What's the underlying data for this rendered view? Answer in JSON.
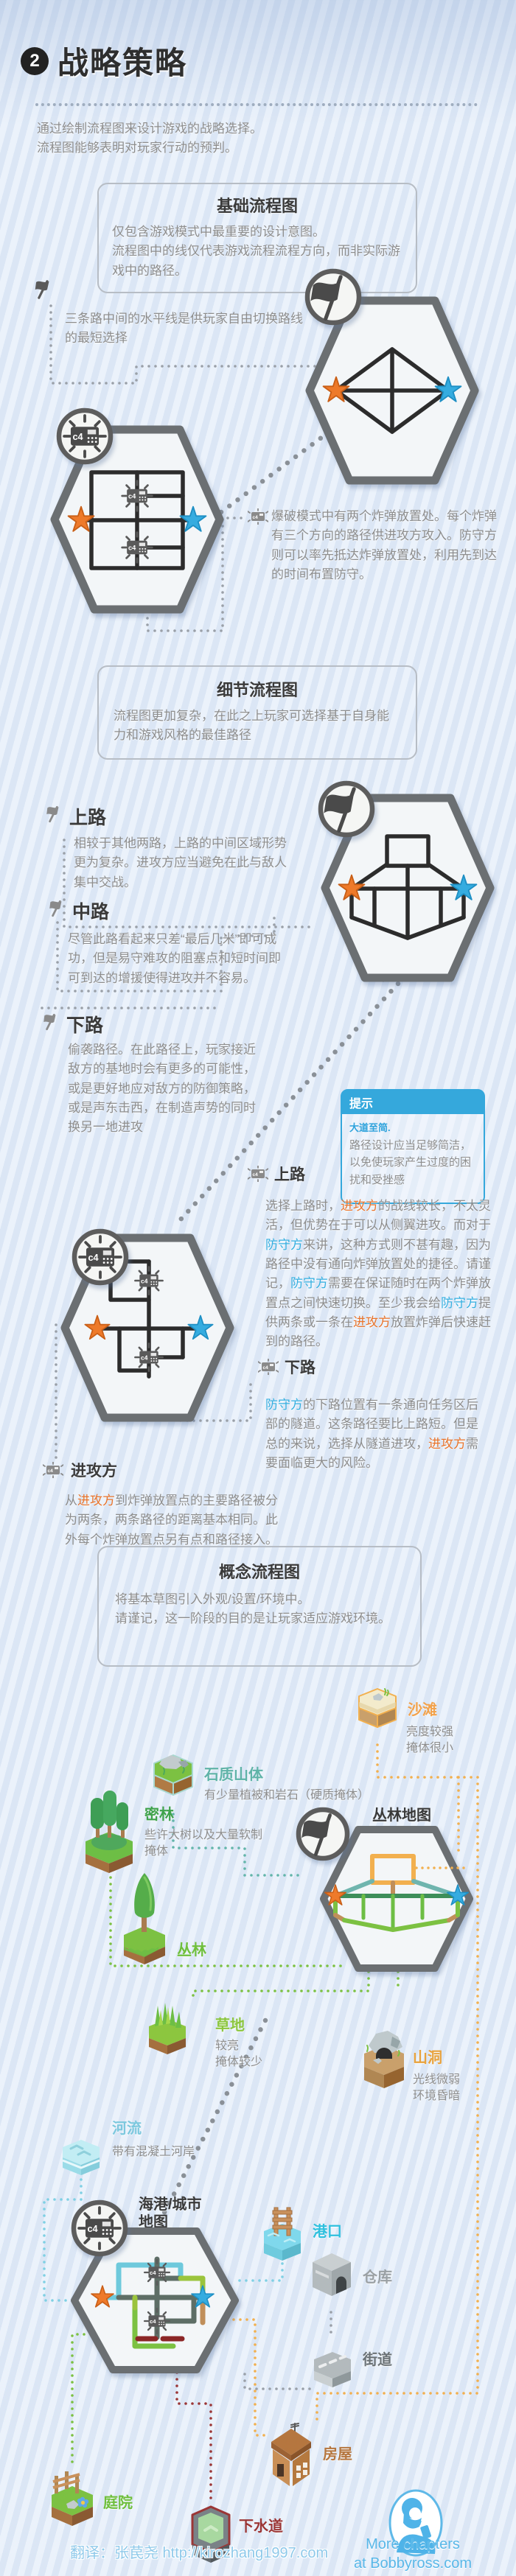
{
  "header": {
    "badge": "2",
    "title": "战略策略"
  },
  "intro": {
    "line1": "通过绘制流程图来设计游戏的战略选择。",
    "line2": "流程图能够表明对玩家行动的预判。"
  },
  "basic_box": {
    "title": "基础流程图",
    "line1": "仅包含游戏模式中最重要的设计意图。",
    "line2": "流程图中的线仅代表游戏流程流程方向，而非实际游戏中的路径。"
  },
  "ctf_note": {
    "text": "三条路中间的水平线是供玩家自由切换路线的最短选择"
  },
  "bomb_note": {
    "text": "爆破模式中有两个炸弹放置处。每个炸弹有三个方向的路径供进攻方攻入。防守方则可以率先抵达炸弹放置处，利用先到达的时间布置防守。"
  },
  "detail_box": {
    "title": "细节流程图",
    "body": "流程图更加复杂，在此之上玩家可选择基于自身能力和游戏风格的最佳路径"
  },
  "ctf_lanes": {
    "top": {
      "label": "上路",
      "body": "相较于其他两路，上路的中间区域形势更为复杂。进攻方应当避免在此与敌人集中交战。"
    },
    "mid": {
      "label": "中路",
      "body": "尽管此路看起来只差“最后几米”即可成功，但是易守难攻的阻塞点和短时间即可到达的增援使得进攻并不容易。"
    },
    "bottom": {
      "label": "下路",
      "body": "偷袭路径。在此路径上，玩家接近敌方的基地时会有更多的可能性，或是更好地应对敌方的防御策略，或是声东击西，在制造声势的同时换另一地进攻"
    }
  },
  "tip": {
    "title": "提示",
    "subtitle": "大道至简.",
    "body": "路径设计应当足够简洁，以免使玩家产生过度的困扰和受挫感"
  },
  "bomb_lanes": {
    "top": {
      "label": "上路",
      "segments": [
        {
          "t": "选择上路时，"
        },
        {
          "t": "进攻方",
          "c": "atk"
        },
        {
          "t": "的战线较长，不太灵活，但优势在于可以从侧翼进攻。而对于"
        },
        {
          "t": "防守方",
          "c": "def"
        },
        {
          "t": "来讲，这种方式则不甚有趣，因为路径中没有通向炸弹放置处的捷径。请谨记，"
        },
        {
          "t": "防守方",
          "c": "def"
        },
        {
          "t": "需要在保证随时在两个炸弹放置点之间快速切换。至少我会给"
        },
        {
          "t": "防守方",
          "c": "def"
        },
        {
          "t": "提供两条或一条在"
        },
        {
          "t": "进攻方",
          "c": "atk"
        },
        {
          "t": "放置炸弹后快速赶到的路径。"
        }
      ]
    },
    "bottom": {
      "label": "下路",
      "segments": [
        {
          "t": "防守方",
          "c": "def"
        },
        {
          "t": "的下路位置有一条通向任务区后部的隧道。这条路径要比上路短。但是总的来说，选择从隧道进攻，"
        },
        {
          "t": "进攻方",
          "c": "atk"
        },
        {
          "t": "需要面临更大的风险。"
        }
      ]
    },
    "attacker": {
      "label": "进攻方",
      "segments": [
        {
          "t": "从"
        },
        {
          "t": "进攻方",
          "c": "atk"
        },
        {
          "t": "到炸弹放置点的主要路径被分为两条，两条路径的距离基本相同。此外每个炸弹放置点另有点和路径接入。"
        }
      ]
    }
  },
  "concept_box": {
    "title": "概念流程图",
    "line1": "将基本草图引入外观/设置/环境中。",
    "line2": "请谨记，这一阶段的目的是让玩家适应游戏环境。"
  },
  "maps": {
    "jungle": "丛林地图",
    "harbor_line1": "海港/城市",
    "harbor_line2": "地图"
  },
  "terrain": {
    "beach": {
      "label": "沙滩",
      "desc1": "亮度较强",
      "desc2": "掩体很小"
    },
    "rocky": {
      "label": "石质山体",
      "desc1": "有少量植被和岩石（硬质掩体）"
    },
    "dense": {
      "label": "密林",
      "desc1": "些许大树以及大量软制掩体"
    },
    "jungle": {
      "label": "丛林"
    },
    "grass": {
      "label": "草地",
      "desc1": "较亮",
      "desc2": "掩体较少"
    },
    "cave": {
      "label": "山洞",
      "desc1": "光线微弱",
      "desc2": "环境昏暗"
    },
    "river": {
      "label": "河流",
      "desc1": "带有混凝土河岸"
    },
    "port": {
      "label": "港口"
    },
    "warehouse": {
      "label": "仓库"
    },
    "street": {
      "label": "街道"
    },
    "house": {
      "label": "房屋"
    },
    "courtyard": {
      "label": "庭院"
    },
    "sewer": {
      "label": "下水道"
    }
  },
  "footer": {
    "more1": "More chapters",
    "more2": "at Bobbyross.com",
    "translation": "翻译：张苠尧  http://kirozhang1997.com"
  },
  "colors": {
    "attacker": "#e8732a",
    "defender": "#35afe0",
    "tip_accent": "#35a8dc"
  }
}
